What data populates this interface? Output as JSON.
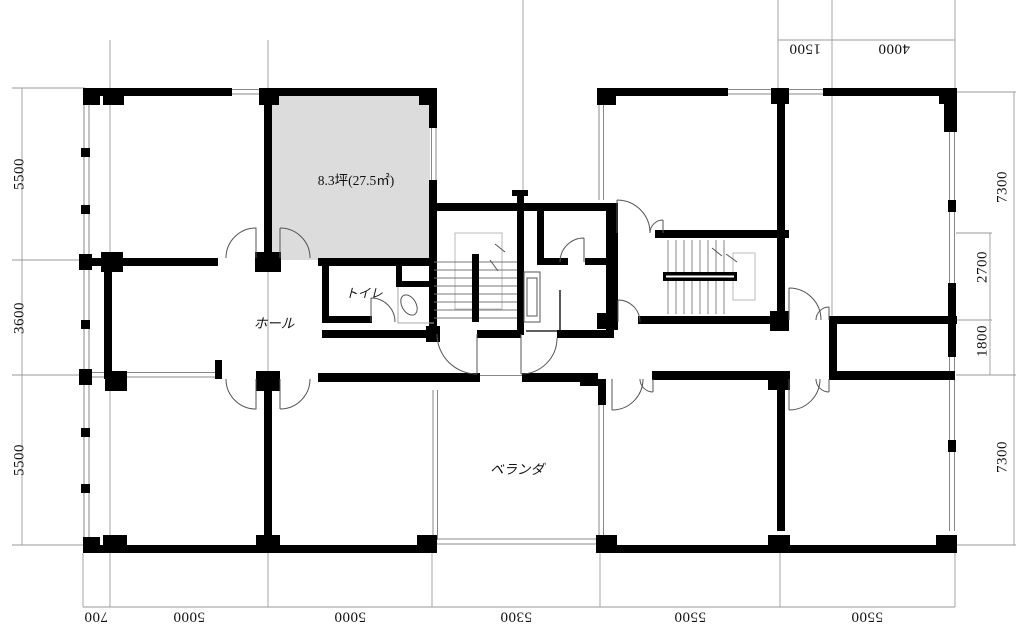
{
  "plan": {
    "rooms": {
      "unit_area": "8.3坪(27.5㎡)",
      "toilet": "トイレ",
      "hall": "ホール",
      "veranda": "ベランダ"
    },
    "dimensions": {
      "left": [
        "5500",
        "3600",
        "5500"
      ],
      "right_outer": [
        "7300",
        "7300"
      ],
      "right_inner": [
        "2700",
        "1800"
      ],
      "top": [
        "1500",
        "4000"
      ],
      "bottom": [
        "700",
        "5000",
        "5000",
        "5300",
        "5500",
        "5500"
      ]
    },
    "colors": {
      "wall": "#000000",
      "unit_fill": "#dcdcdc",
      "grid_line": "#9a9a9a",
      "door_line": "#555555",
      "background": "#ffffff"
    }
  }
}
